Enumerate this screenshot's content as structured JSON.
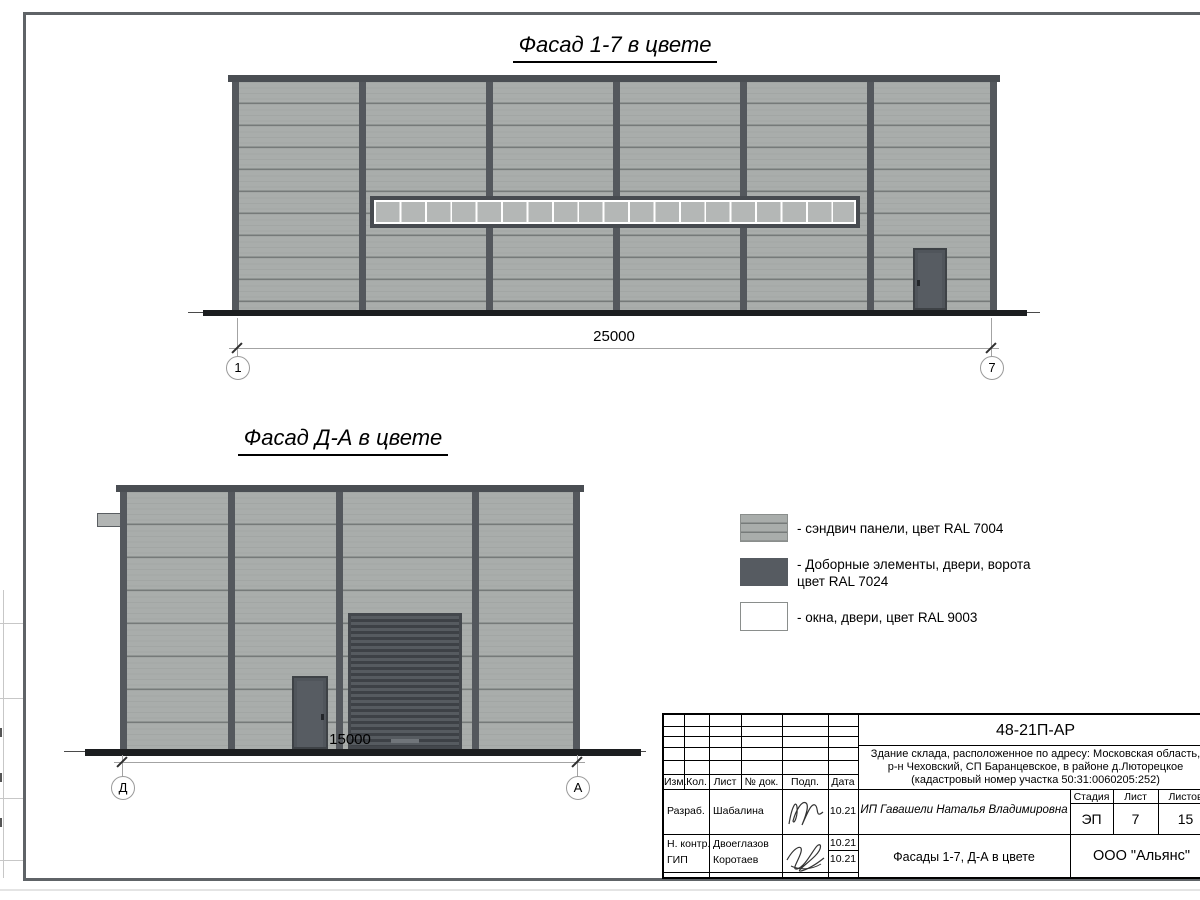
{
  "colors": {
    "panel": "#a9adab",
    "panel_stripe": "#878c8a",
    "dark_elements": "#54585d",
    "window_pane": "#b4b7b6",
    "white": "#ffffff"
  },
  "facade_top": {
    "title": "Фасад 1-7 в цвете",
    "dimension": "25000",
    "axis_left": "1",
    "axis_right": "7"
  },
  "facade_side": {
    "title": "Фасад Д-А в цвете",
    "dimension": "15000",
    "axis_left": "Д",
    "axis_right": "А"
  },
  "legend": {
    "items": [
      {
        "label": "- сэндвич панели, цвет RAL 7004"
      },
      {
        "label": "- Доборные элементы, двери, ворота",
        "label2": "цвет RAL 7024"
      },
      {
        "label": "- окна, двери, цвет RAL 9003"
      }
    ]
  },
  "title_block": {
    "code": "48-21П-АР",
    "address1": "Здание склада, расположенное по адресу: Московская область,",
    "address2": "р-н Чеховский, СП Баранцевское, в районе д.Люторецкое",
    "address3": "(кадастровый номер участка 50:31:0060205:252)",
    "headers": {
      "izm": "Изм.",
      "kol": "Кол.",
      "list": "Лист",
      "doc": "№ док.",
      "podp": "Подп.",
      "data": "Дата"
    },
    "rows": [
      {
        "role": "Разраб.",
        "name": "Шабалина",
        "date": "10.21"
      },
      {
        "role": "Н. контр.",
        "name": "Двоеглазов",
        "date": "10.21"
      },
      {
        "role": "ГИП",
        "name": "Коротаев",
        "date": "10.21"
      }
    ],
    "client": "ИП Гавашели Наталья Владимировна",
    "stage_label": "Стадия",
    "sheet_label": "Лист",
    "sheets_label": "Листов",
    "stage": "ЭП",
    "sheet": "7",
    "sheets": "15",
    "doc_title": "Фасады 1-7, Д-А в цвете",
    "company": "ООО \"Альянс\""
  }
}
